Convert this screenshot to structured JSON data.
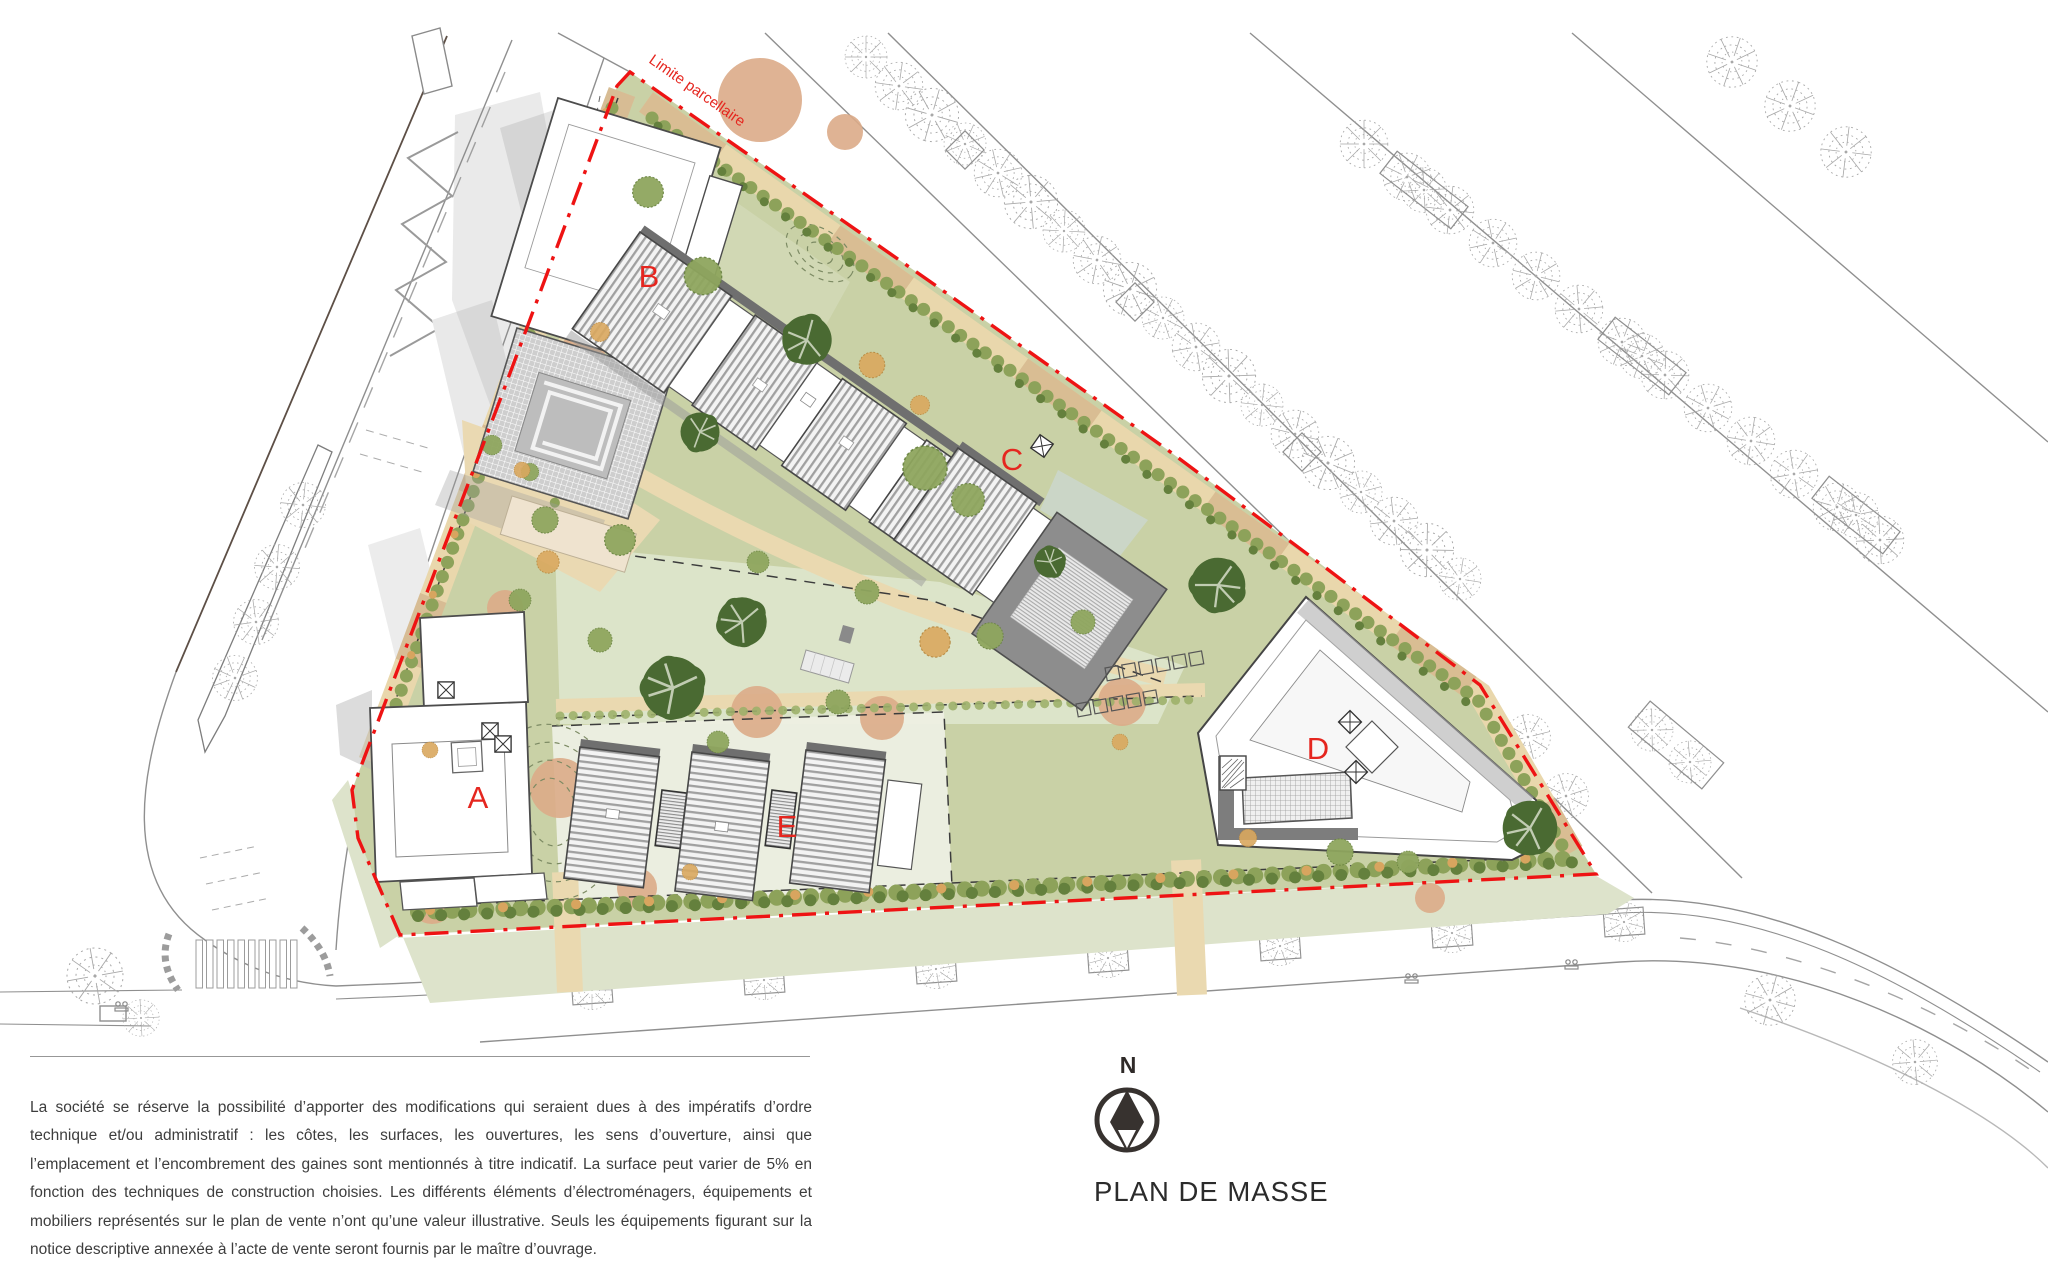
{
  "plan": {
    "title": "PLAN DE MASSE",
    "north_label": "N",
    "boundary_label": "Limite parcellaire",
    "buildings": [
      {
        "id": "A",
        "label": "A"
      },
      {
        "id": "B",
        "label": "B"
      },
      {
        "id": "C",
        "label": "C"
      },
      {
        "id": "D",
        "label": "D"
      },
      {
        "id": "E",
        "label": "E"
      }
    ]
  },
  "disclaimer": {
    "text": "La société se réserve la possibilité d’apporter des modifications qui seraient dues à des impératifs d’ordre technique et/ou administratif : les côtes, les surfaces, les ouvertures, les sens d’ouverture, ainsi que l’emplacement et l’encombrement des gaines sont mentionnés à titre indicatif. La surface peut varier de 5% en fonction des techniques de construction choisies. Les différents éléments d’électroménagers, équipements et mobiliers représentés sur le plan de vente n’ont qu’une valeur illustrative. Seuls les équipements figurant sur la notice descriptive annexée à l’acte de vente seront fournis par le maître d’ouvrage."
  },
  "colors": {
    "boundary_red": "#ee1313",
    "label_red": "#e5261f",
    "site_green": "#c9d1a6",
    "lawn_light": "#dee5cd",
    "path_beige": "#ead9b2",
    "hedge_olive": "#8da25a",
    "tree_dark_green": "#4a6a32",
    "shrub_orange": "#d9a75e",
    "ground_peach": "#dcab88",
    "roof_gray": "#8d8d8d",
    "line_gray": "#8f8f8f"
  }
}
